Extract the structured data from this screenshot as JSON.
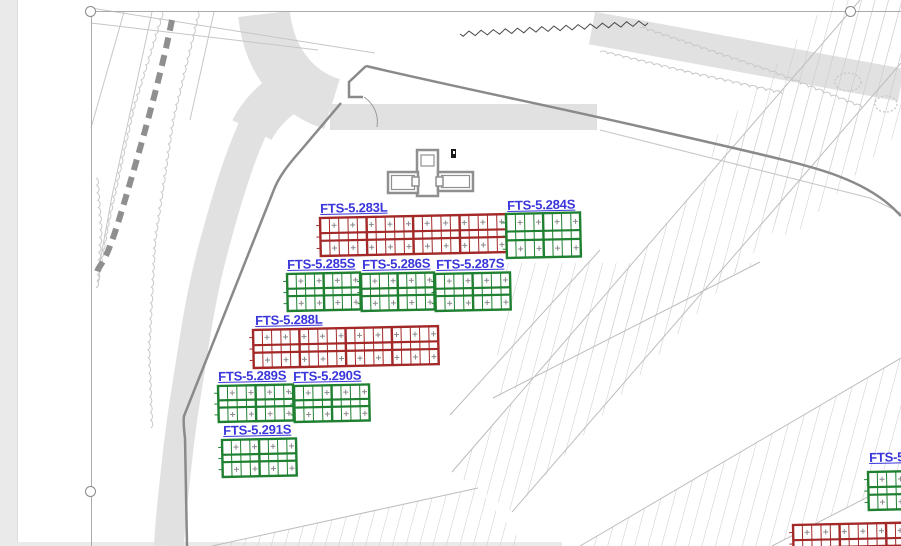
{
  "page": {
    "margin_color": "#eaeaea",
    "background": "#ffffff"
  },
  "selection": {
    "frame_color": "#ababab",
    "handle_positions": [
      {
        "x": 91,
        "y": 12
      },
      {
        "x": 851,
        "y": 12
      },
      {
        "x": 91,
        "y": 492
      }
    ]
  },
  "plan": {
    "label_color": "#3a36db",
    "palette": {
      "red": "#a32828",
      "green": "#1e8030"
    },
    "line_colors": {
      "boundary": "#8a8a8a",
      "road_fill": "#e1e1e1",
      "thin": "#c6c6c6",
      "hatch": "#cdcdd1",
      "wavy": "#c8c8c8",
      "jagged": "#4a4a4a",
      "dashed_line": "#8f8f8f",
      "building": "#8f8f8f"
    },
    "blocks": [
      {
        "label": "FTS-5.283L",
        "color": "red",
        "x": 320,
        "y": 218,
        "w": 186,
        "h": 38,
        "cols": 20,
        "group_every": 5,
        "label_x": 320,
        "label_y": 202
      },
      {
        "label": "FTS-5.284S",
        "color": "green",
        "x": 506,
        "y": 214,
        "w": 74,
        "h": 44,
        "cols": 8,
        "group_every": 4,
        "label_x": 507,
        "label_y": 199
      },
      {
        "label": "FTS-5.285S",
        "color": "green",
        "x": 287,
        "y": 274,
        "w": 73,
        "h": 37,
        "cols": 8,
        "group_every": 4,
        "label_x": 287,
        "label_y": 258
      },
      {
        "label": "FTS-5.286S",
        "color": "green",
        "x": 361,
        "y": 274,
        "w": 73,
        "h": 37,
        "cols": 8,
        "group_every": 4,
        "label_x": 362,
        "label_y": 258
      },
      {
        "label": "FTS-5.287S",
        "color": "green",
        "x": 435,
        "y": 274,
        "w": 75,
        "h": 37,
        "cols": 8,
        "group_every": 4,
        "label_x": 436,
        "label_y": 258
      },
      {
        "label": "FTS-5.288L",
        "color": "red",
        "x": 253,
        "y": 330,
        "w": 185,
        "h": 38,
        "cols": 20,
        "group_every": 5,
        "label_x": 255,
        "label_y": 314
      },
      {
        "label": "FTS-5.289S",
        "color": "green",
        "x": 218,
        "y": 386,
        "w": 75,
        "h": 36,
        "cols": 8,
        "group_every": 4,
        "label_x": 218,
        "label_y": 370
      },
      {
        "label": "FTS-5.290S",
        "color": "green",
        "x": 294,
        "y": 386,
        "w": 75,
        "h": 36,
        "cols": 8,
        "group_every": 4,
        "label_x": 293,
        "label_y": 370
      },
      {
        "label": "FTS-5.291S",
        "color": "green",
        "x": 222,
        "y": 440,
        "w": 74,
        "h": 37,
        "cols": 8,
        "group_every": 4,
        "label_x": 223,
        "label_y": 424
      },
      {
        "label": "FTS-5",
        "color": "green",
        "x": 868,
        "y": 472,
        "w": 74,
        "h": 38,
        "cols": 8,
        "group_every": 4,
        "label_x": 869,
        "label_y": 451
      },
      {
        "label": "",
        "color": "red",
        "x": 793,
        "y": 525,
        "w": 186,
        "h": 38,
        "cols": 20,
        "group_every": 5
      }
    ]
  }
}
